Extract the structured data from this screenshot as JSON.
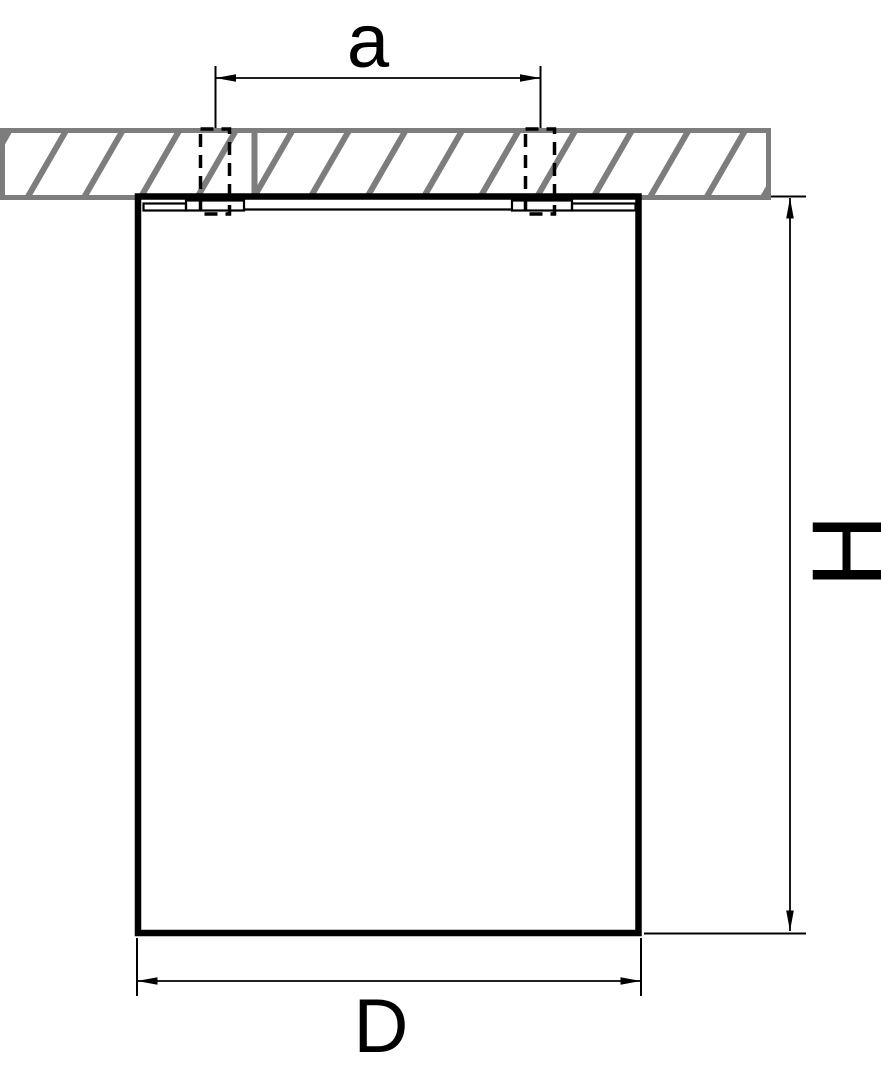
{
  "labels": {
    "dim_a": "a",
    "dim_h": "H",
    "dim_d": "D"
  },
  "colors": {
    "line": "#000000",
    "hatch_gray": "#7d7d7d",
    "background": "#ffffff"
  }
}
